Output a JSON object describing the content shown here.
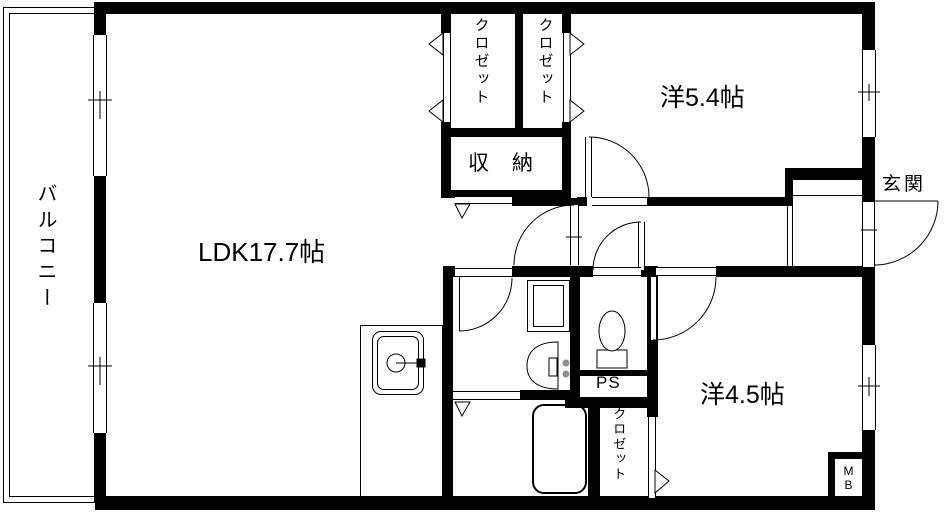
{
  "colors": {
    "wall": "#000000",
    "background": "#ffffff",
    "knob": "#8f8f8f"
  },
  "rooms": {
    "balcony": {
      "label": "バルコニー"
    },
    "ldk": {
      "label": "LDK17.7帖"
    },
    "western_room_5_4": {
      "label": "洋5.4帖"
    },
    "western_room_4_5": {
      "label": "洋4.5帖"
    },
    "entrance": {
      "label": "玄関"
    },
    "storage": {
      "label": "収　納"
    },
    "closet_top_left": {
      "label": "クロゼット"
    },
    "closet_top_right": {
      "label": "クロゼット"
    },
    "closet_bottom": {
      "label": "クロゼット"
    },
    "pipe_space": {
      "label": "PS"
    },
    "meter_box": {
      "line1": "M",
      "line2": "B"
    }
  }
}
